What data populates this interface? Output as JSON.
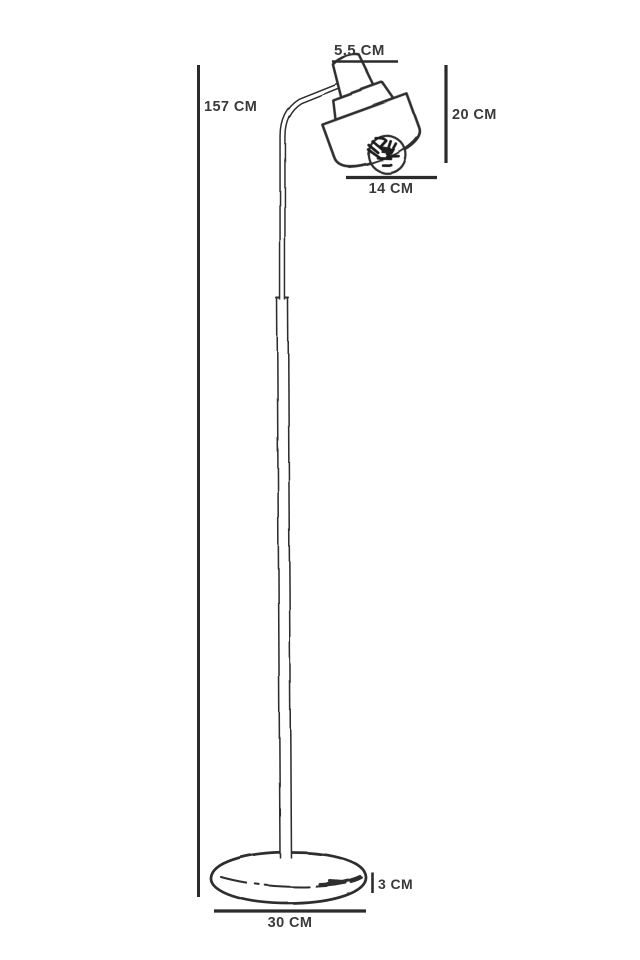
{
  "diagram": {
    "subject": "floor lamp technical line drawing with dimensions",
    "background_color": "#ffffff",
    "ink_color": "#2d2d2d",
    "label_color": "#3a3a3a",
    "dimension_labels": {
      "total_height": "157 CM",
      "head_top_width": "5.5 CM",
      "head_height": "20 CM",
      "head_width": "14 CM",
      "base_thickness": "3 CM",
      "base_width": "30 CM"
    }
  }
}
